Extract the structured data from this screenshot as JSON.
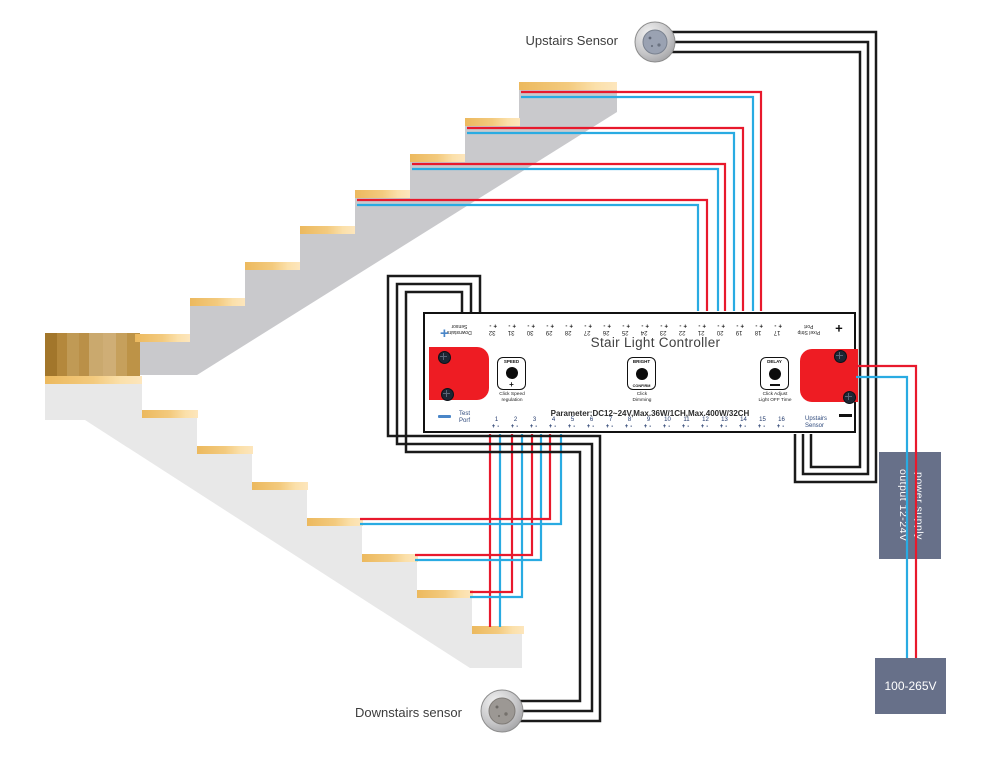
{
  "colors": {
    "wire_red": "#e8192c",
    "wire_blue": "#29abe2",
    "wire_black": "#1a1a1a",
    "connector_red": "#ee1c23",
    "box_slate": "#677089",
    "slab_upper_gray": "#c9c9cc",
    "slab_lower_gray": "#e8e8e8",
    "terminal_navy": "#22396b",
    "accent_blue": "#4a86c8"
  },
  "labels": {
    "upstairs_sensor": "Upstairs Sensor",
    "downstairs_sensor": "Downstairs sensor",
    "power_supply_line1": "power supply",
    "power_supply_line2": "output 12-24V",
    "mains_voltage": "100-265V"
  },
  "controller": {
    "title": "Stair Light Controller",
    "parameter": "Parameter:DC12~24V,Max.36W/1CH,Max.400W/32CH",
    "plus": "+",
    "minus": "-",
    "top_corner_plus": "+",
    "left_plus": "+",
    "pixel_port_line1": "Pixel Strip",
    "pixel_port_line2": "Port",
    "downstairs_line1": "Downstairs",
    "downstairs_line2": "Sensor",
    "test_port_line1": "Test",
    "test_port_line2": "Porf",
    "upstairs_line1": "Upstairs",
    "upstairs_line2": "Sensor",
    "top_terminals_displayed": [
      32,
      31,
      30,
      29,
      28,
      27,
      26,
      25,
      24,
      23,
      22,
      21,
      20,
      19,
      18,
      17
    ],
    "bottom_terminals": [
      1,
      2,
      3,
      4,
      5,
      6,
      7,
      8,
      9,
      10,
      11,
      12,
      13,
      14,
      15,
      16
    ],
    "buttons": {
      "speed": {
        "top": "SPEED",
        "bottom": "+",
        "caption_line1": "Click Speed",
        "caption_line2": "regulation"
      },
      "bright": {
        "top": "BRIGHT",
        "bottom": "CONFIRM",
        "caption_line1": "Click",
        "caption_line2": "Dimming"
      },
      "delay": {
        "top": "DELAY",
        "bottom": "",
        "caption_line1": "Click Adjust",
        "caption_line2": "Light OFF Time"
      }
    }
  }
}
